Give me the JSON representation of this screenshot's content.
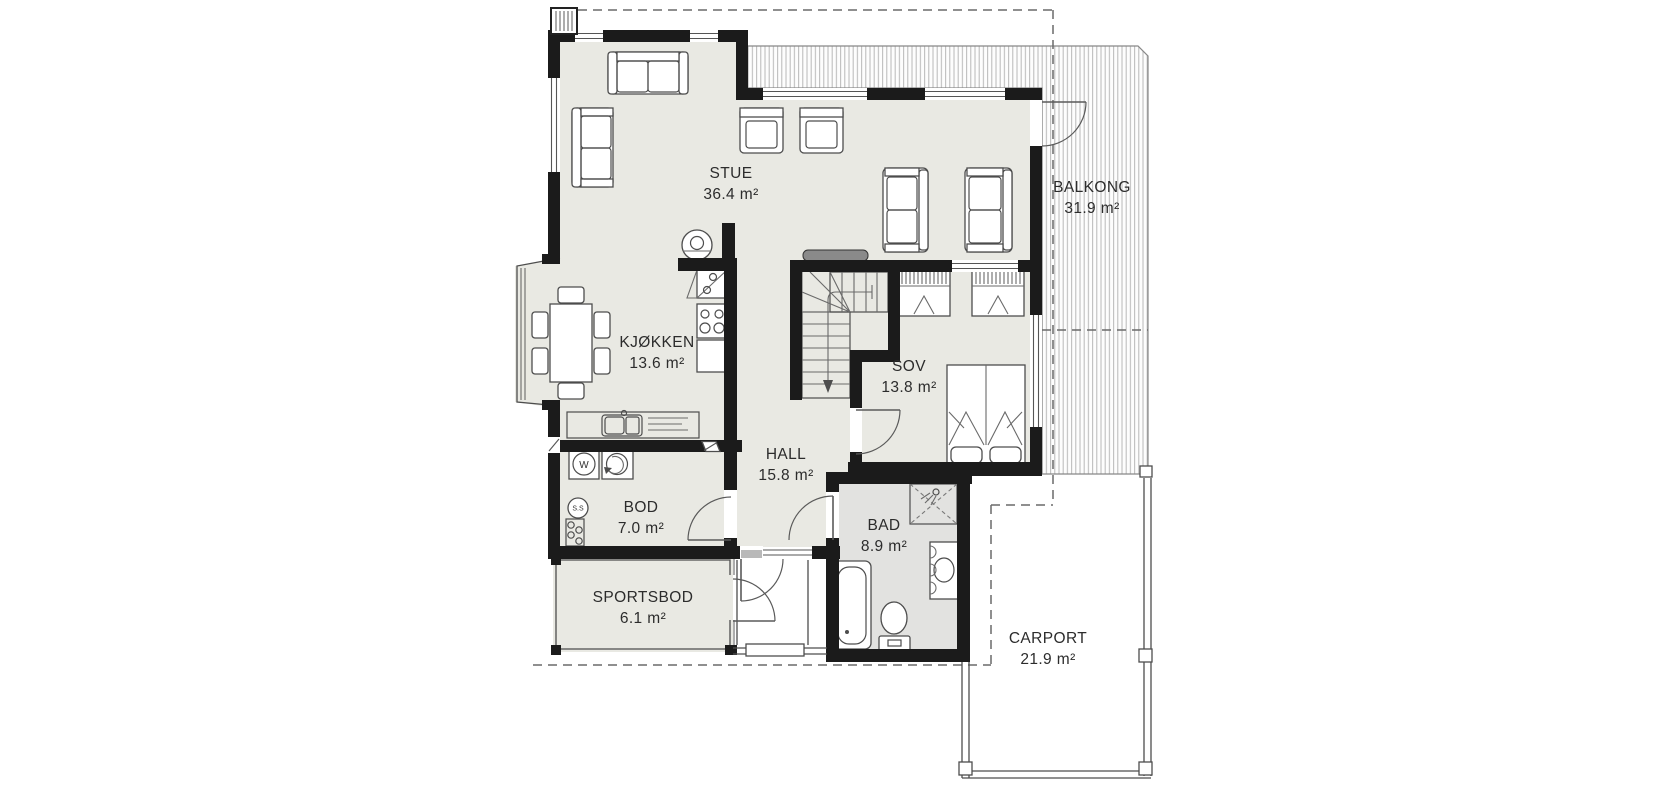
{
  "floorplan": {
    "rooms": [
      {
        "name": "STUE",
        "area": "36.4 m²"
      },
      {
        "name": "KJØKKEN",
        "area": "13.6 m²"
      },
      {
        "name": "SOV",
        "area": "13.8 m²"
      },
      {
        "name": "HALL",
        "area": "15.8 m²"
      },
      {
        "name": "BOD",
        "area": "7.0 m²"
      },
      {
        "name": "BAD",
        "area": "8.9 m²"
      },
      {
        "name": "SPORTSBOD",
        "area": "6.1 m²"
      },
      {
        "name": "BALKONG",
        "area": "31.9 m²"
      },
      {
        "name": "CARPORT",
        "area": "21.9 m²"
      }
    ],
    "symbols": {
      "washing_machine": "W",
      "floor_drain": "S.S"
    },
    "colors": {
      "wall": "#1b1b1b",
      "floor": "#e9e9e3",
      "bathroom_floor": "#e2e2e0",
      "hatch": "#b9b9b9",
      "line": "#4d4d4d",
      "text": "#2c2c2c",
      "background": "#ffffff"
    }
  }
}
